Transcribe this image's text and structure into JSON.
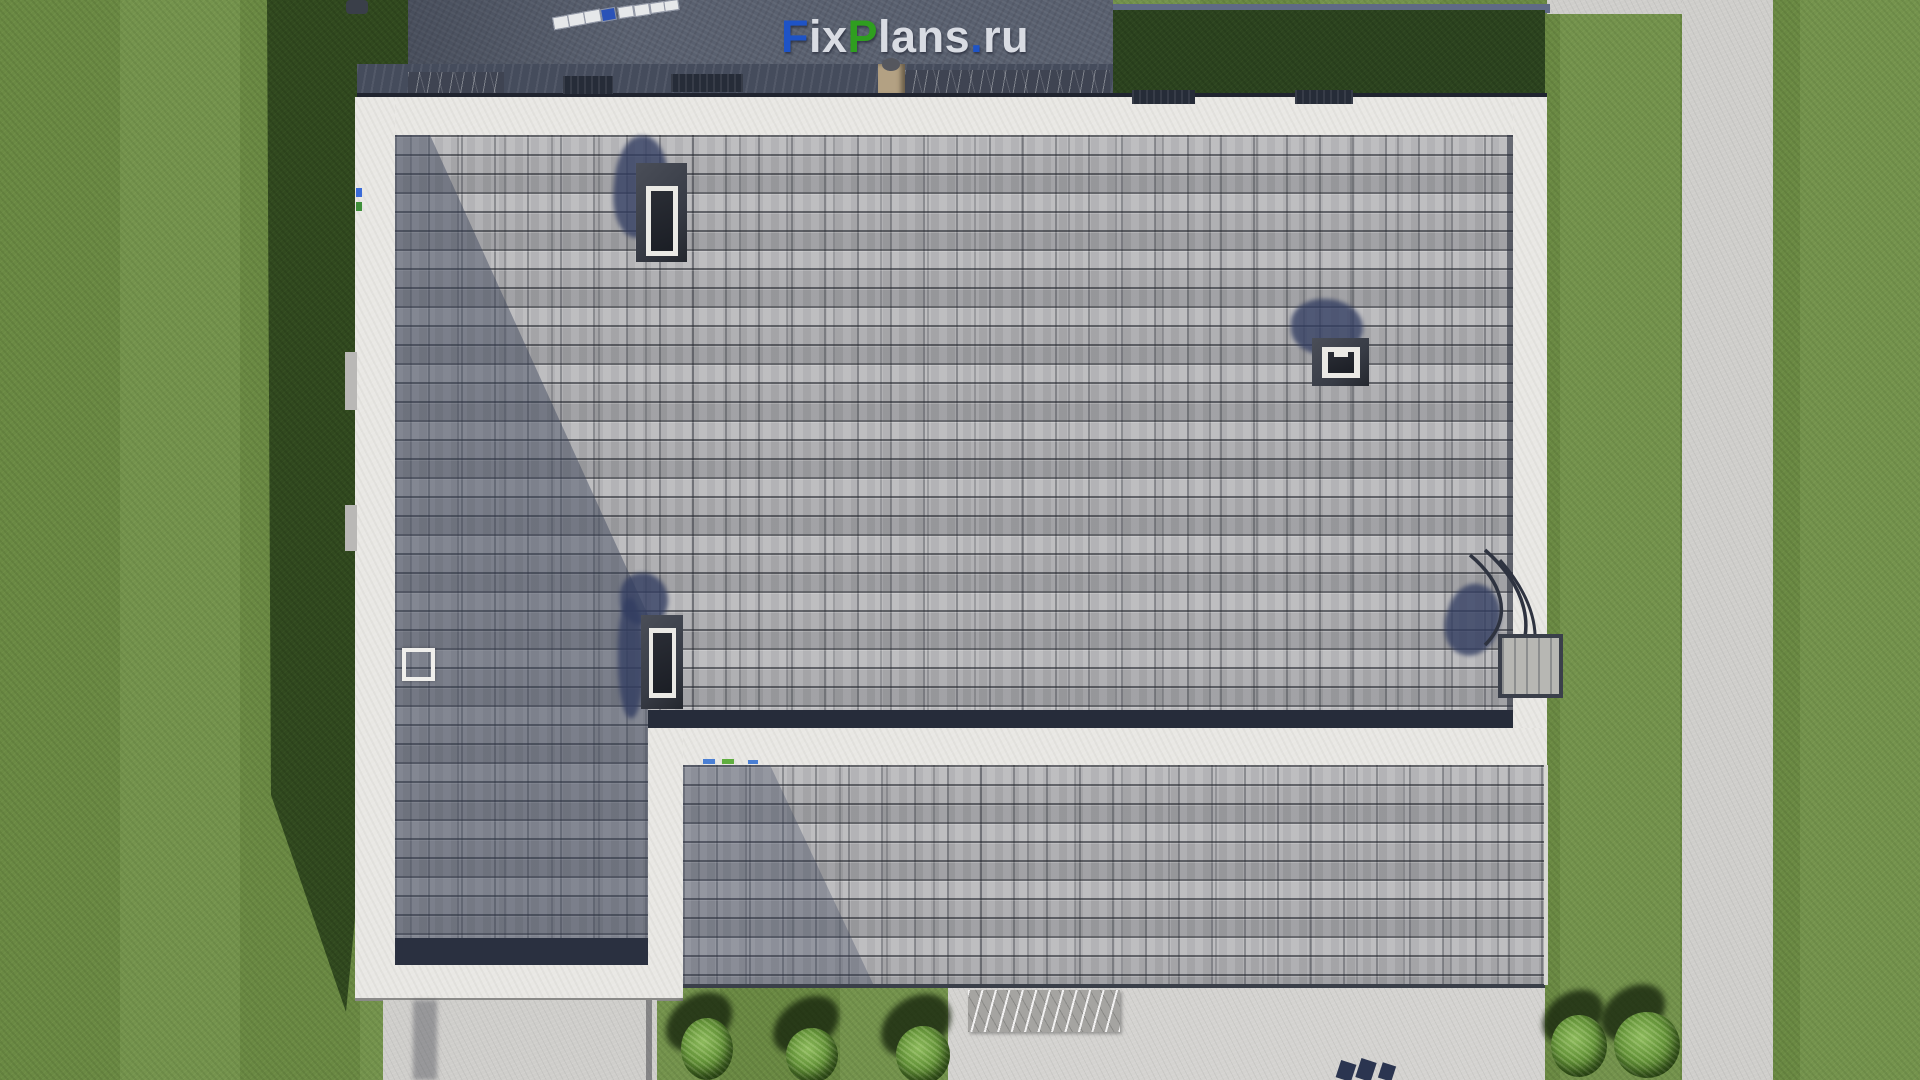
{
  "watermark": {
    "parts": [
      {
        "text": "F",
        "color": "#1e53c6"
      },
      {
        "text": "ix",
        "color": "#d9dce3"
      },
      {
        "text": "P",
        "color": "#2f9e1f"
      },
      {
        "text": "lans",
        "color": "#d9dce3"
      },
      {
        "text": ".",
        "color": "#1e53c6"
      },
      {
        "text": "ru",
        "color": "#d9dce3"
      }
    ]
  },
  "palette": {
    "grass": "#6f8f46",
    "grass_shadow": "#31491f",
    "dark_green_patch": "#2c431f",
    "deck": "#59606f",
    "deck_strip": "#454c5c",
    "blue_strip": "#5f6a85",
    "eave": "#e9e8e4",
    "path": "#cfcecb",
    "patio": "#d4d3d0",
    "shingle": "#b2b2b5",
    "step": "#262c3a",
    "skylight_frame": "#383c46",
    "skylight_white": "#eae9e5",
    "skylight_glass": "#1b1e25",
    "shadow_blob": "#323d61",
    "bush": "#649339",
    "bush_shadow": "#16240c",
    "marble_dark": "#3f4452",
    "marble_light": "#a5a4a1",
    "planter": "#b3a183",
    "vent": "#262c38",
    "wire": "#2e3340",
    "platform": "#b7b7b3",
    "paver": "#2b3550",
    "object_white": "#e6e8ea",
    "object_blue": "#2a52b8"
  },
  "inventory": {
    "skylights": 3,
    "roof_vents": 4,
    "bushes_front": 3,
    "bushes_side": 2,
    "deck_objects": 8
  }
}
